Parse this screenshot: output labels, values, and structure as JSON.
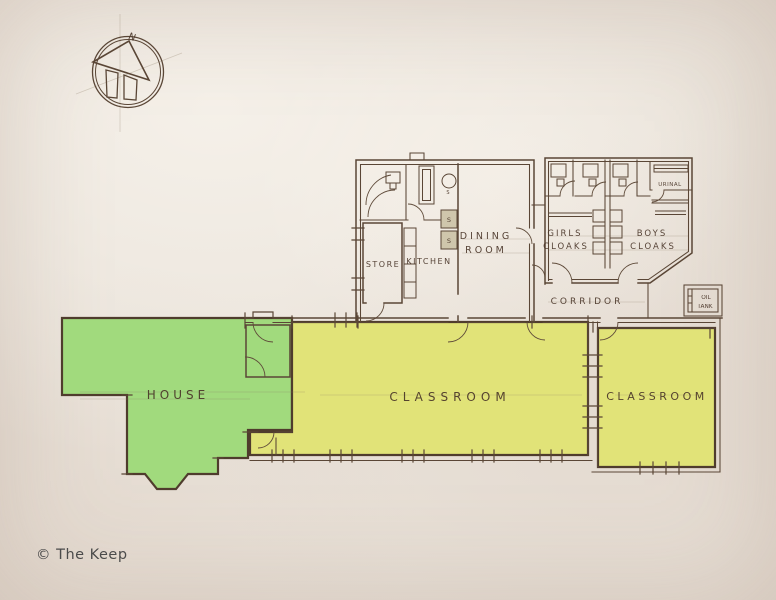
{
  "compass": {
    "north_label": "N"
  },
  "colors": {
    "paper": "#e9e2d9",
    "house_green": "#a1da7d",
    "classroom_yellow": "#e1e378",
    "ink": "#5a4636",
    "label_ink": "#4a3629"
  },
  "rooms": {
    "store": "STORE",
    "kitchen": "KITCHEN",
    "dining_line1": "DINING",
    "dining_line2": "ROOM",
    "girls_line1": "GIRLS",
    "girls_line2": "CLOAKS",
    "boys_line1": "BOYS",
    "boys_line2": "CLOAKS",
    "urinal": "URINAL",
    "corridor": "CORRIDOR",
    "oil_line1": "OIL",
    "oil_line2": "TANK",
    "house": "HOUSE",
    "classroom_main": "CLASSROOM",
    "classroom_small": "CLASSROOM",
    "sink_label": "S"
  },
  "footer": {
    "copyright": "© The Keep"
  }
}
